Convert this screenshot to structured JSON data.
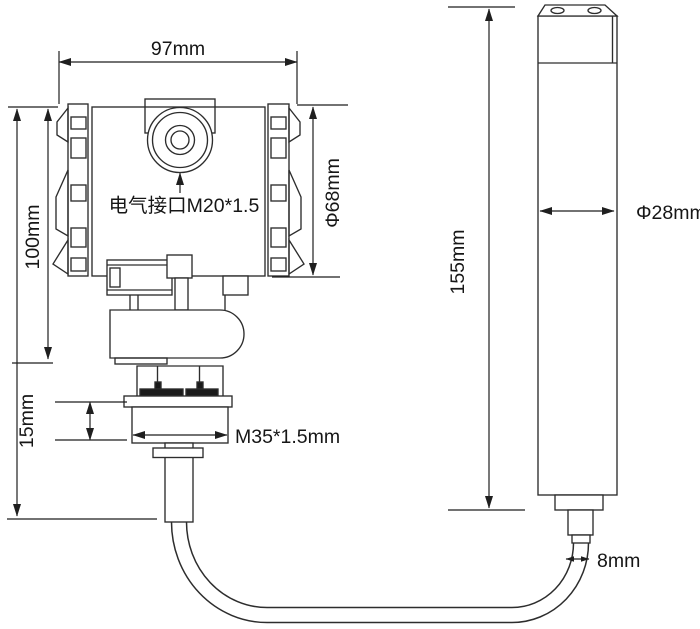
{
  "diagram": {
    "type": "technical-dimension-drawing",
    "subject": "submersible level transmitter with cable and probe",
    "background": "#ffffff",
    "line_color": "#2d2d2d",
    "dim_color": "#1f1f1f",
    "text_color": "#161616",
    "labels": {
      "head_width": "97mm",
      "head_height": "100mm",
      "electrical_interface": "电气接口M20*1.5",
      "head_diameter": "Φ68mm",
      "thread_height": "15mm",
      "thread_spec": "M35*1.5mm",
      "probe_length": "155mm",
      "probe_diameter": "Φ28mm",
      "cable_diameter": "8mm"
    }
  }
}
